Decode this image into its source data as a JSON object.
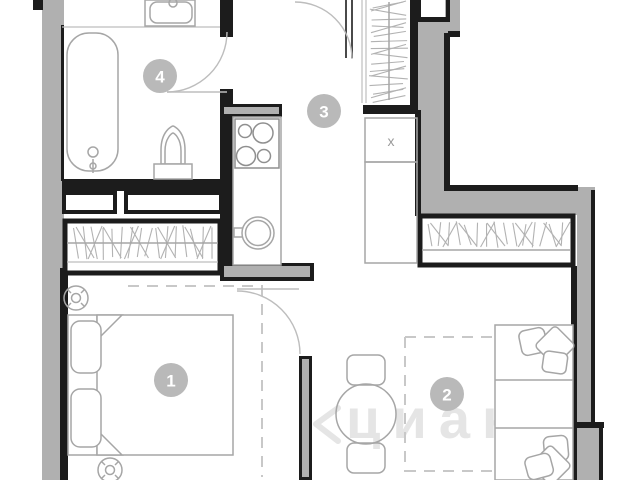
{
  "plan": {
    "title": "apartment-floor-plan",
    "room_labels": [
      {
        "number": "1"
      },
      {
        "number": "2"
      },
      {
        "number": "3"
      },
      {
        "number": "4"
      }
    ],
    "shaft_label": "x",
    "watermark": {
      "icon": "chevron-left-icon",
      "text": "циан"
    },
    "colors": {
      "wall": "#1c1c1c",
      "gray": "#b0b0b0",
      "furn": "#a6a6a6",
      "furn-dark": "#8f8f8f",
      "hatch": "#b2b2b2",
      "dash": "#c8c8c8",
      "label-bg": "#b9b9b9",
      "label-text": "#ffffff",
      "wm": "#e3e3e3",
      "bg": "#ffffff"
    }
  }
}
